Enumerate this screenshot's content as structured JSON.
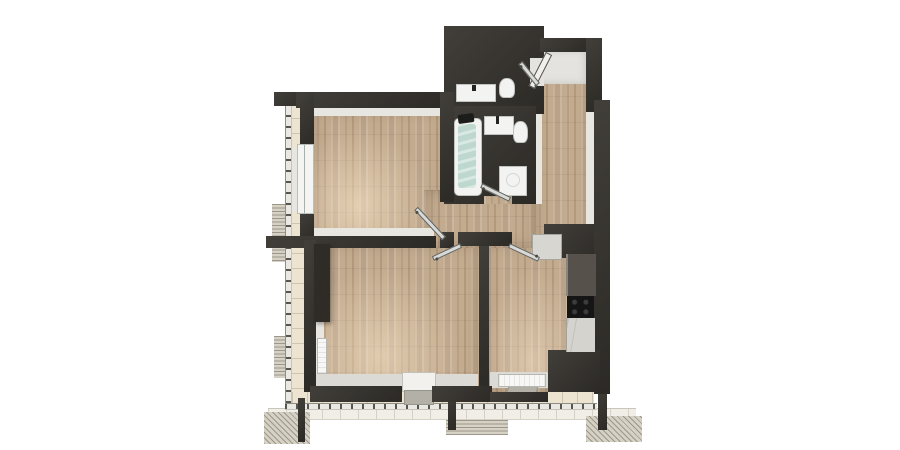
{
  "scene": {
    "description": "3D top-down rendered architectural floor plan of an apartment with wrap-around balcony",
    "background": "#ffffff",
    "view": "top-down axonometric render",
    "visible_text": ""
  },
  "palette": {
    "wall": "#36332e",
    "wall_dark": "#2b2925",
    "lining": "#e8e6e1",
    "wood": "#c3ab8f",
    "tile_floor": "#e9ebea",
    "tile_teal": "#4a7b8c",
    "water": "#bed8cf",
    "balcony_floor": "#ece4d0",
    "walkway": "#f0eee6",
    "hatch_dark": "#9d978b",
    "hatch_light": "#d6d1c5",
    "fixture": "#f3f4f2",
    "fixture_edge": "#bfc2bf",
    "counter_dark": "#56524b",
    "counter_marble": "#d5d3ce",
    "cooktop": "#151515",
    "door_leaf": "#d8dad8",
    "wardrobe_dark": "#2f2c28",
    "radiator": "#f7f7f5",
    "mat": "#b3b0a8"
  },
  "rooms": [
    {
      "id": "living-room",
      "floor": "wood-plank",
      "fixtures": [
        "window-to-balcony",
        "interior-door"
      ]
    },
    {
      "id": "bedroom",
      "floor": "wood-plank",
      "fixtures": [
        "wardrobe",
        "wall-radiator",
        "windows",
        "balcony-door"
      ]
    },
    {
      "id": "kitchen",
      "floor": "wood-plank",
      "fixtures": [
        "kitchen-counter",
        "cooktop",
        "fridge",
        "window",
        "radiator",
        "balcony-door"
      ]
    },
    {
      "id": "hallway",
      "floor": "wood-plank",
      "fixtures": [
        "entrance-door",
        "white-wardrobe"
      ]
    },
    {
      "id": "bathroom",
      "floor": "white-tile",
      "fixtures": [
        "bathtub",
        "sink-vanity",
        "toilet",
        "washing-machine"
      ],
      "wall_finish": "teal-tile"
    },
    {
      "id": "wc",
      "floor": "white-tile",
      "fixtures": [
        "sink-vanity",
        "toilet"
      ],
      "wall_finish": "teal-tile"
    },
    {
      "id": "balcony",
      "floor": "ceramic-tile",
      "shape": "L-wrap-left-and-bottom",
      "fixtures": [
        "glass-balustrade",
        "facade-louver-panels",
        "columns"
      ]
    }
  ],
  "doors": [
    "entrance-door",
    "wc-door",
    "bathroom-door",
    "living-room-door",
    "bedroom-door",
    "kitchen-door"
  ],
  "counts": {
    "rooms": 4,
    "wet_rooms": 2,
    "doors_shown_open": 6,
    "windows": 4
  }
}
